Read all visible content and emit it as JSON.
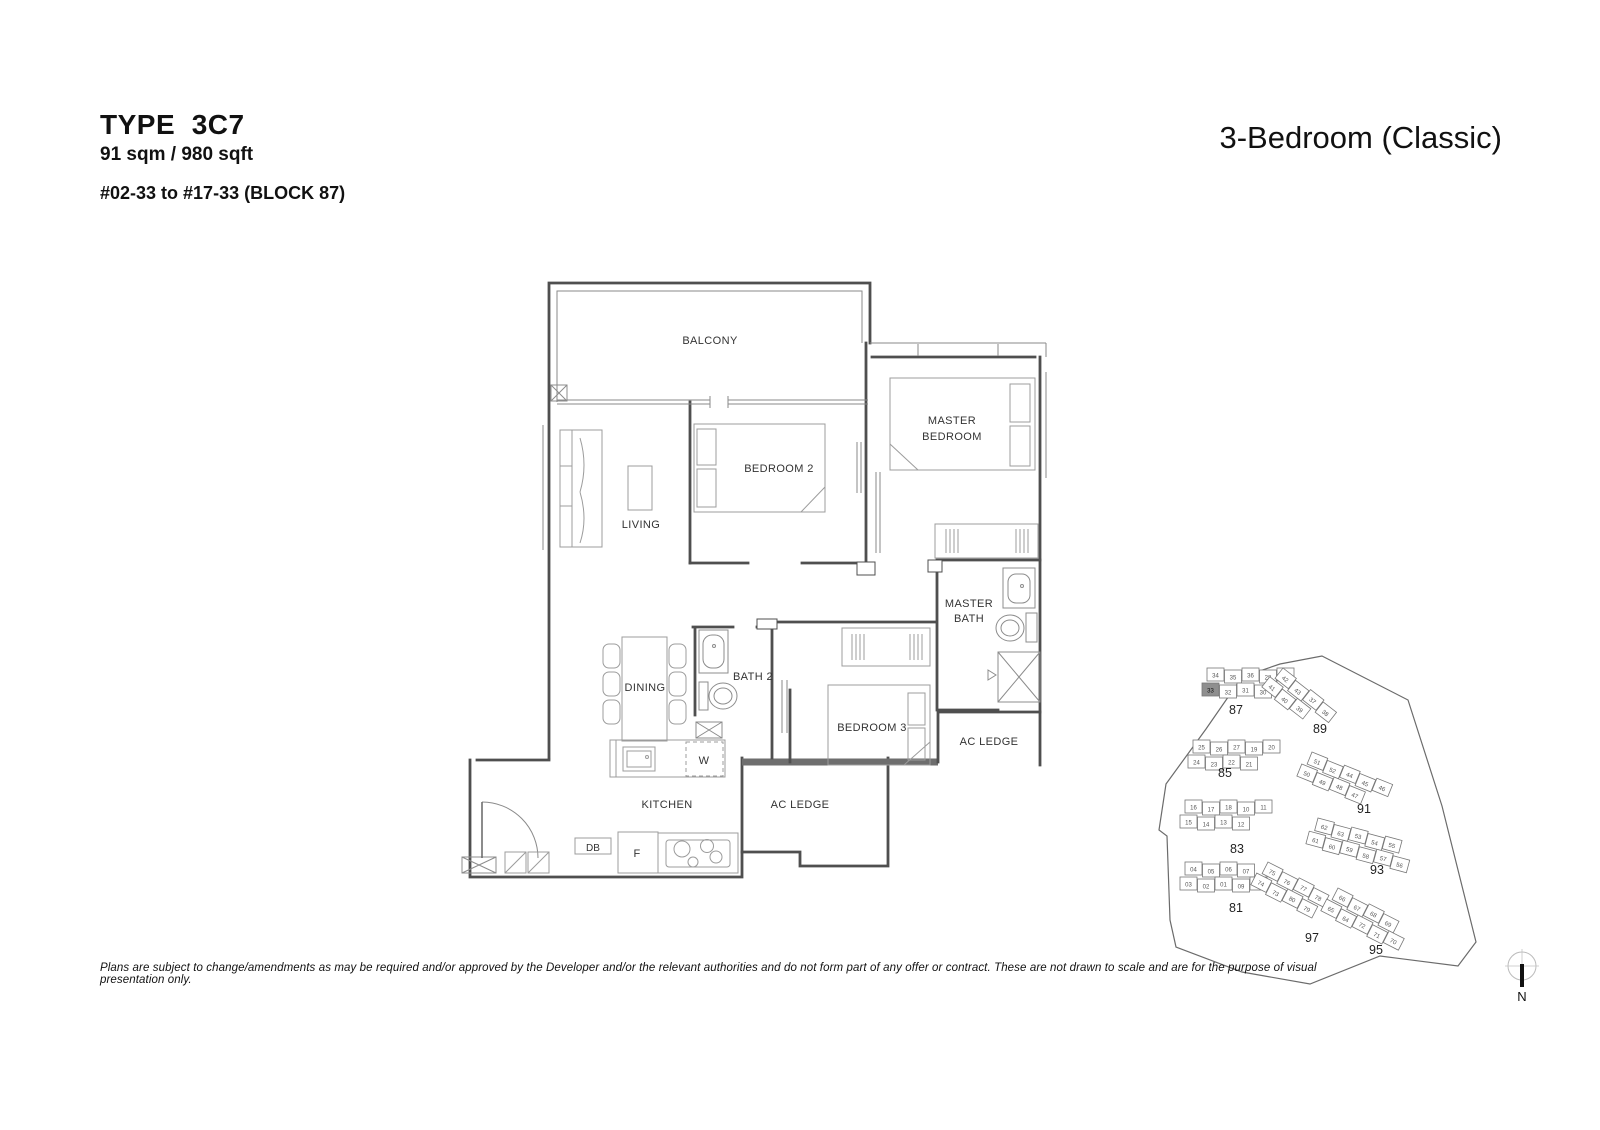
{
  "header": {
    "type_label": "TYPE  3C7",
    "area": "91 sqm / 980 sqft",
    "stack": "#02-33 to #17-33 (BLOCK 87)",
    "category": "3-Bedroom (Classic)"
  },
  "floorplan": {
    "rooms": {
      "balcony": "BALCONY",
      "living": "LIVING",
      "bedroom2": "BEDROOM 2",
      "master_bedroom": [
        "MASTER",
        "BEDROOM"
      ],
      "master_bath": [
        "MASTER",
        "BATH"
      ],
      "dining": "DINING",
      "bath2": "BATH 2",
      "bedroom3": "BEDROOM 3",
      "ac_ledge_right": "AC LEDGE",
      "ac_ledge_bottom": "AC LEDGE",
      "kitchen": "KITCHEN"
    },
    "appliances": {
      "washer": "W",
      "db": "DB",
      "fridge": "F"
    }
  },
  "site_plan": {
    "highlight": {
      "block": "87",
      "unit": "33"
    },
    "highlight_color": "#8f8f8f",
    "blocks": [
      {
        "label": "87",
        "x": 1207,
        "y": 668,
        "rot": 0,
        "label_x": 1236,
        "label_y": 714,
        "rows": [
          [
            "34",
            "35",
            "36",
            "28",
            "29"
          ],
          [
            "33",
            "32",
            "31",
            "30"
          ]
        ]
      },
      {
        "label": "89",
        "x": 1283,
        "y": 668,
        "rot": 38,
        "label_x": 1320,
        "label_y": 733,
        "rows": [
          [
            "42",
            "43",
            "37",
            "38"
          ],
          [
            "41",
            "40",
            "39"
          ]
        ]
      },
      {
        "label": "85",
        "x": 1193,
        "y": 740,
        "rot": 0,
        "label_x": 1225,
        "label_y": 777,
        "rows": [
          [
            "25",
            "26",
            "27",
            "19",
            "20"
          ],
          [
            "24",
            "23",
            "22",
            "21"
          ]
        ]
      },
      {
        "label": "91",
        "x": 1312,
        "y": 752,
        "rot": 22,
        "label_x": 1364,
        "label_y": 813,
        "rows": [
          [
            "51",
            "52",
            "44",
            "45",
            "46"
          ],
          [
            "50",
            "49",
            "48",
            "47"
          ]
        ]
      },
      {
        "label": "83",
        "x": 1185,
        "y": 800,
        "rot": 0,
        "label_x": 1237,
        "label_y": 853,
        "rows": [
          [
            "16",
            "17",
            "18",
            "10",
            "11"
          ],
          [
            "15",
            "14",
            "13",
            "12"
          ]
        ]
      },
      {
        "label": "93",
        "x": 1318,
        "y": 818,
        "rot": 15,
        "label_x": 1377,
        "label_y": 874,
        "rows": [
          [
            "62",
            "63",
            "53",
            "54",
            "55"
          ],
          [
            "61",
            "60",
            "59",
            "58",
            "57",
            "56"
          ]
        ]
      },
      {
        "label": "81",
        "x": 1185,
        "y": 862,
        "rot": 0,
        "label_x": 1236,
        "label_y": 912,
        "rows": [
          [
            "04",
            "05",
            "06",
            "07"
          ],
          [
            "03",
            "02",
            "01",
            "09",
            "08"
          ]
        ]
      },
      {
        "label": "97",
        "x": 1268,
        "y": 862,
        "rot": 27,
        "label_x": 1312,
        "label_y": 942,
        "rows": [
          [
            "75",
            "76",
            "77",
            "78"
          ],
          [
            "74",
            "73",
            "80",
            "79"
          ]
        ]
      },
      {
        "label": "95",
        "x": 1338,
        "y": 888,
        "rot": 27,
        "label_x": 1376,
        "label_y": 954,
        "rows": [
          [
            "66",
            "67",
            "68",
            "69"
          ],
          [
            "65",
            "64",
            "72",
            "71",
            "70"
          ]
        ]
      }
    ]
  },
  "compass": {
    "north_label": "N"
  },
  "footer": {
    "disclaimer": "Plans are subject to change/amendments as may be required and/or approved by the Developer and/or the relevant authorities and do not form part of any offer or contract. These are not drawn to scale and are for the purpose of visual presentation only."
  }
}
